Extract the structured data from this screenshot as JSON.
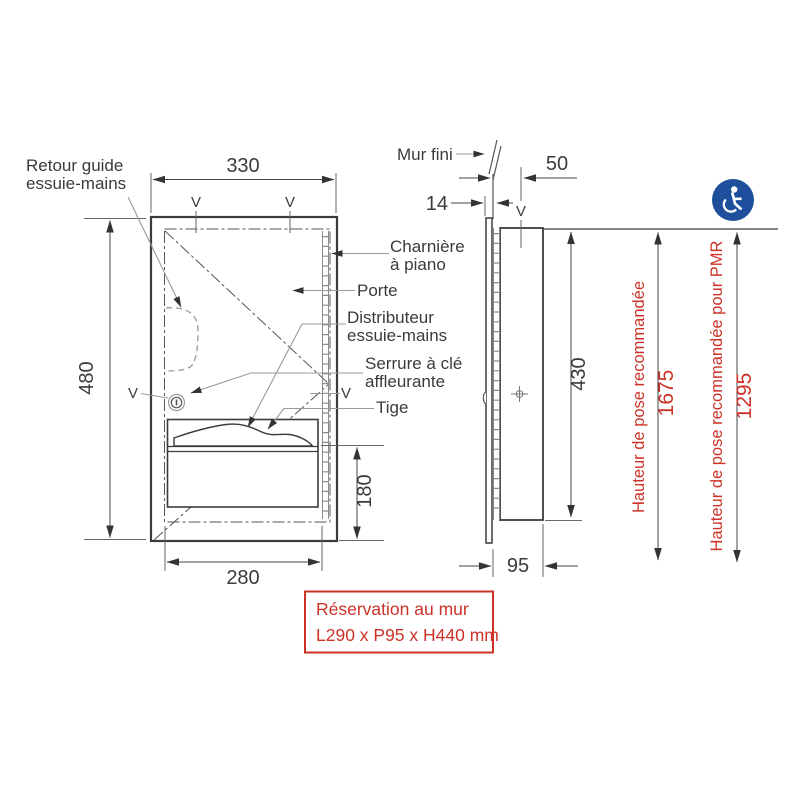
{
  "colors": {
    "accent_red": "#cc3227",
    "icon_blue": "#1d4f9c",
    "line": "#3b3b3b"
  },
  "front_view": {
    "dim_width_top": "330",
    "dim_height": "480",
    "dim_width_bottom": "280",
    "dim_opening_height": "180",
    "label_retour_1": "Retour guide",
    "label_retour_2": "essuie-mains",
    "label_charniere_1": "Charnière",
    "label_charniere_2": "à piano",
    "label_porte": "Porte",
    "label_distributeur_1": "Distributeur",
    "label_distributeur_2": "essuie-mains",
    "label_serrure_1": "Serrure à clé",
    "label_serrure_2": "affleurante",
    "label_tige": "Tige"
  },
  "side_view": {
    "label_mur_fini": "Mur fini",
    "dim_offset": "50",
    "dim_door": "14",
    "dim_height": "430",
    "dim_depth": "95"
  },
  "marks": {
    "v": "V"
  },
  "heights": {
    "standard_label": "Hauteur de pose recommandée",
    "standard_value": "1675",
    "pmr_label": "Hauteur de pose recommandée pour PMR",
    "pmr_value": "1295"
  },
  "reservation": {
    "line1": "Réservation au mur",
    "line2": "L290 x P95 x H440 mm"
  },
  "icons": {
    "accessibility": "wheelchair-icon"
  }
}
